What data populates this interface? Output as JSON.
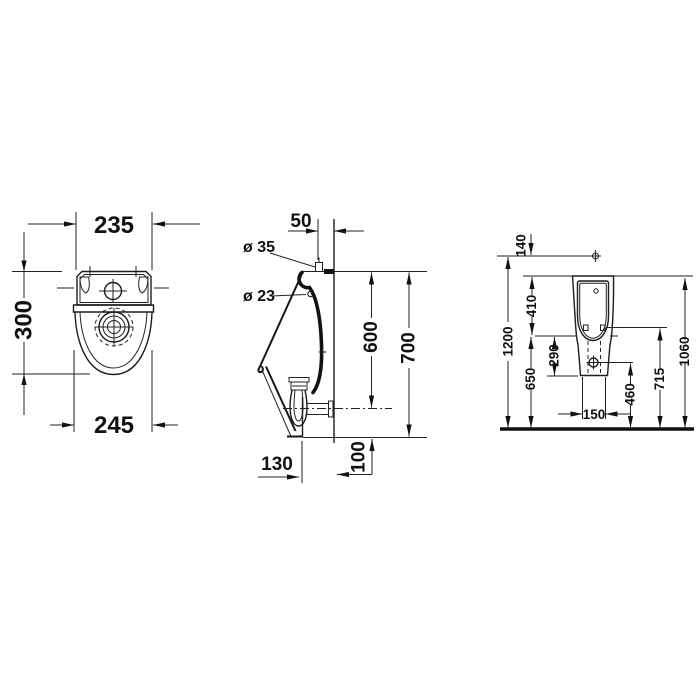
{
  "drawing": {
    "kind": "sanitary technical drawing, wall-hung urinal, 3 orthographic views, dimensions in mm"
  },
  "dims": {
    "plan_width_top": "235",
    "plan_depth": "300",
    "plan_width_bowl": "245",
    "side_wall_offset": "50",
    "side_inlet_dia": "ø 35",
    "side_hole_dia": "ø 23",
    "side_height_to_outlet": "600",
    "side_total_height": "700",
    "side_base_depth": "130",
    "side_below_outlet": "100",
    "front_supply_gap": "140",
    "front_supply_height": "1200",
    "front_top_to_rim": "410",
    "front_rim_to_bottom": "290",
    "front_rim_height": "650",
    "front_fixing_height": "715",
    "front_top_height": "1060",
    "front_drain_height": "460",
    "front_fixing_spacing": "150"
  }
}
